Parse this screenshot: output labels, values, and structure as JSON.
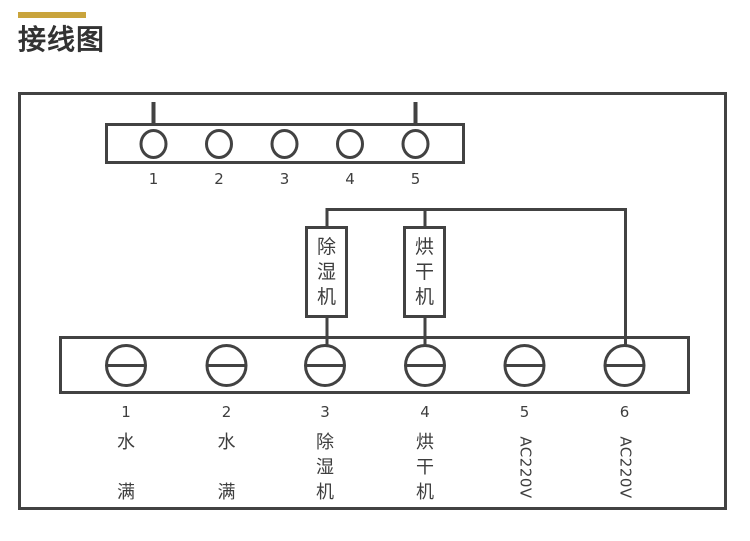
{
  "title": "接线图",
  "colors": {
    "accent_gold": "#c9a43c",
    "line_gray": "#424242",
    "text_gray": "#3e3e3e",
    "background": "#ffffff"
  },
  "top_terminal_block": {
    "terminals": [
      {
        "num": "1"
      },
      {
        "num": "2"
      },
      {
        "num": "3"
      },
      {
        "num": "4"
      },
      {
        "num": "5"
      }
    ]
  },
  "components": [
    {
      "id": "dehumidifier",
      "chars": [
        "除",
        "湿",
        "机"
      ]
    },
    {
      "id": "dryer",
      "chars": [
        "烘",
        "干",
        "机"
      ]
    }
  ],
  "bottom_terminal_block": {
    "terminals": [
      {
        "num": "1",
        "lines": [
          "水",
          "",
          "满"
        ]
      },
      {
        "num": "2",
        "lines": [
          "水",
          "",
          "满"
        ]
      },
      {
        "num": "3",
        "lines": [
          "除",
          "湿",
          "机"
        ]
      },
      {
        "num": "4",
        "lines": [
          "烘",
          "干",
          "机"
        ]
      },
      {
        "num": "5",
        "rotated_label": "AC220V"
      },
      {
        "num": "6",
        "rotated_label": "AC220V"
      }
    ]
  }
}
